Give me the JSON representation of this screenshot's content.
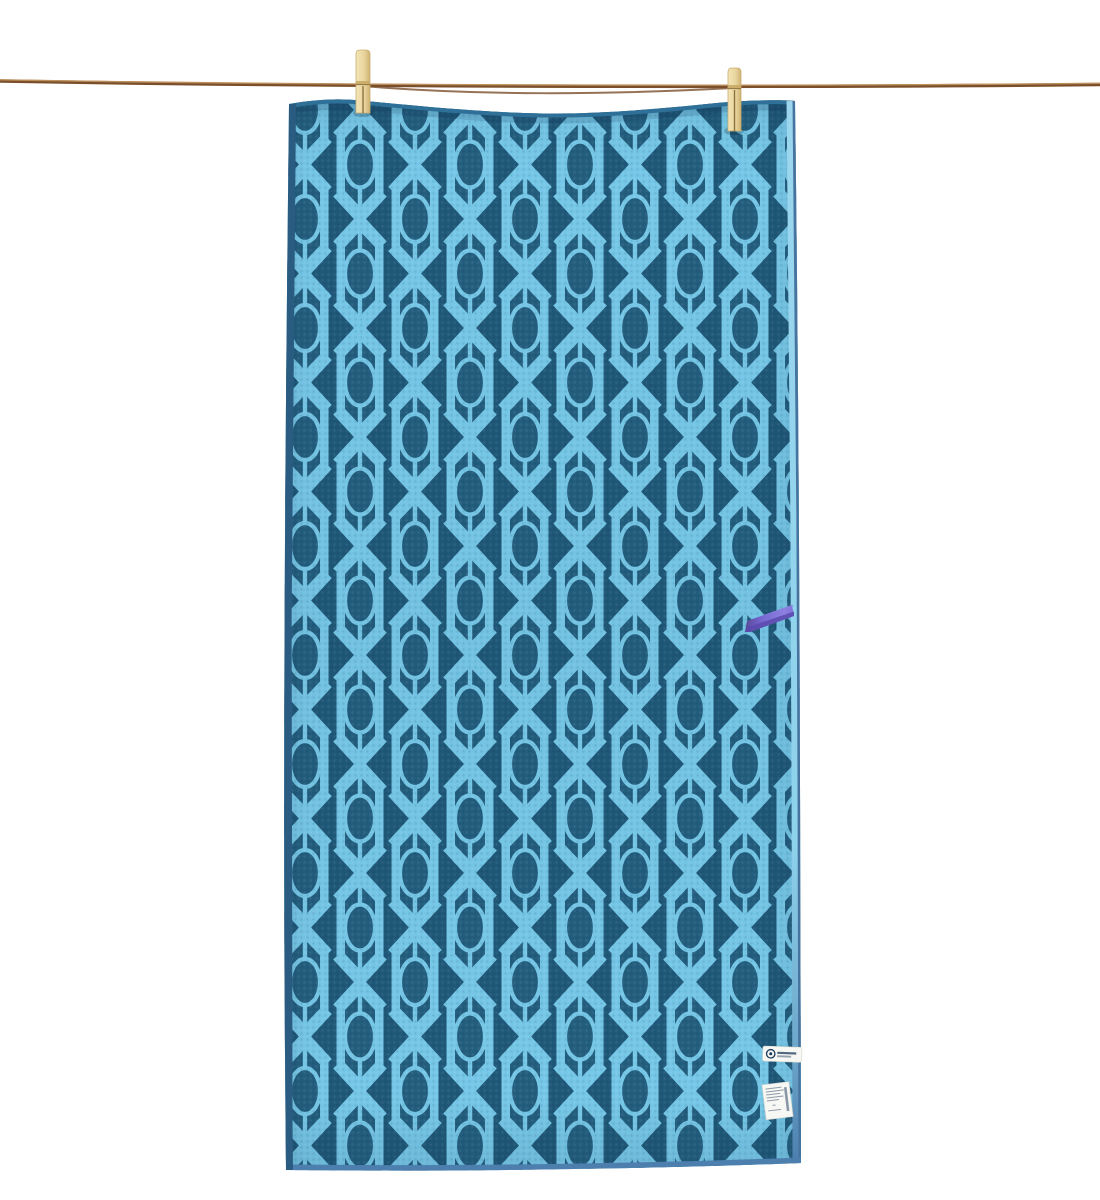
{
  "scene": {
    "type": "product-photo",
    "description": "Blue patterned quick-dry towel with a diamond-lattice and oval motif, hanging from a brown clothesline by two wooden clothespins, with a purple hang loop on its right edge and two small white tags (brand patch and care label) near the bottom right corner",
    "background": "#ffffff"
  },
  "colors": {
    "towel_dark": "#1f5878",
    "towel_oval": "#235e7e",
    "towel_light": "#76c7e7",
    "hem_left": "#2a5c82",
    "hem_top": "#2f7098",
    "hem_bottom": "#4c7fae",
    "hem_right_dark": "#46749f",
    "rope_dark": "#7b4f2b",
    "rope_light": "#c0925e",
    "pin_light": "#f2e3b4",
    "pin_mid": "#caa866",
    "pin_dark": "#c9ad6f",
    "pin_line": "#8d7340",
    "strap_main": "#7668d2",
    "strap_light": "#8d80e0",
    "strap_dark": "#5a4aad",
    "tag_bg": "#f7f7f4",
    "tag_border": "#d9d9d3",
    "tag_text": "#8e9aa8",
    "logo_navy": "#1b3a5a"
  },
  "rope": {
    "strands": 2,
    "material": "twine"
  },
  "clothespins": {
    "count": 2,
    "material": "wood",
    "positions": [
      "left-of-center",
      "right-of-center"
    ]
  },
  "towel": {
    "pattern_name": "diamond-lattice-with-ovals",
    "pattern_column_width_px": 55,
    "pattern_row_height_px": 109
  },
  "tags": {
    "hang_loop": {
      "color_name": "purple",
      "position": "right-edge-middle"
    },
    "brand_patch": {
      "shape": "rounded-rect",
      "logo": "circle-logo",
      "text_legible": false
    },
    "care_label": {
      "shape": "rect",
      "text_legible": false,
      "position": "bottom-right"
    }
  }
}
